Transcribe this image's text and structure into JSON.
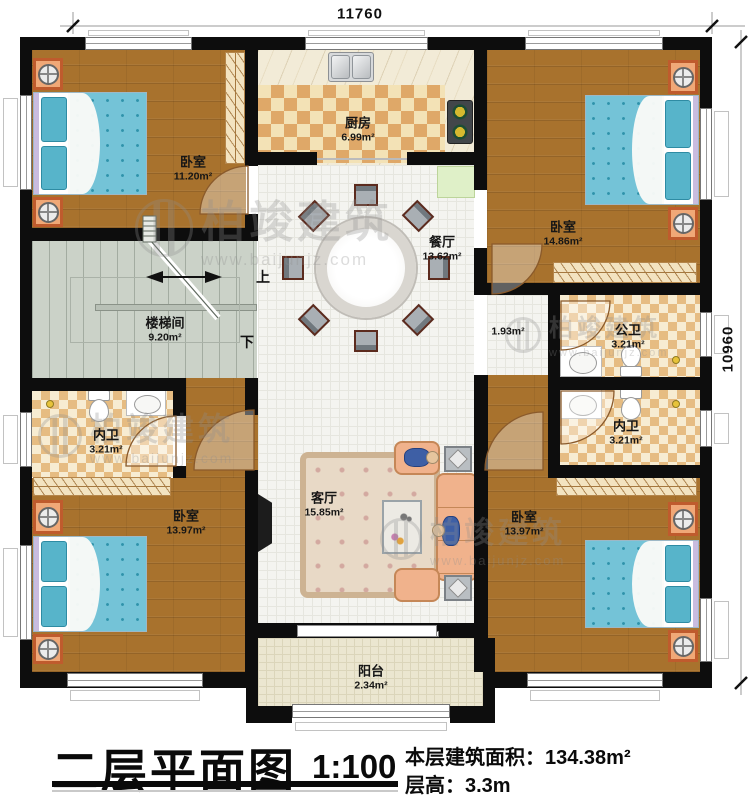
{
  "dimensions": {
    "top": "11760",
    "right": "10960"
  },
  "stairs": {
    "label": "楼梯间",
    "area": "9.20m²",
    "up": "上",
    "down": "下"
  },
  "rooms": {
    "bedroom_tl": {
      "name": "卧室",
      "area": "11.20m²"
    },
    "kitchen": {
      "name": "厨房",
      "area": "6.99m²"
    },
    "bedroom_tr": {
      "name": "卧室",
      "area": "14.86m²"
    },
    "dining": {
      "name": "餐厅",
      "area": "13.62m²"
    },
    "corridor": {
      "area": "1.93m²"
    },
    "public_bath": {
      "name": "公卫",
      "area": "3.21m²"
    },
    "ensuite_left": {
      "name": "内卫",
      "area": "3.21m²"
    },
    "ensuite_right": {
      "name": "内卫",
      "area": "3.21m²"
    },
    "bedroom_bl": {
      "name": "卧室",
      "area": "13.97m²"
    },
    "bedroom_br": {
      "name": "卧室",
      "area": "13.97m²"
    },
    "living": {
      "name": "客厅",
      "area": "15.85m²"
    },
    "balcony": {
      "name": "阳台",
      "area": "2.34m²"
    }
  },
  "watermark": {
    "brand": "柏竣建筑",
    "url": "www.baijunjz.com"
  },
  "title": {
    "text": "二层平面图",
    "scale": "1:100",
    "area_label": "本层建筑面积：",
    "area_value": "134.38m²",
    "floor_height_label": "层高：",
    "floor_height_value": "3.3m"
  }
}
